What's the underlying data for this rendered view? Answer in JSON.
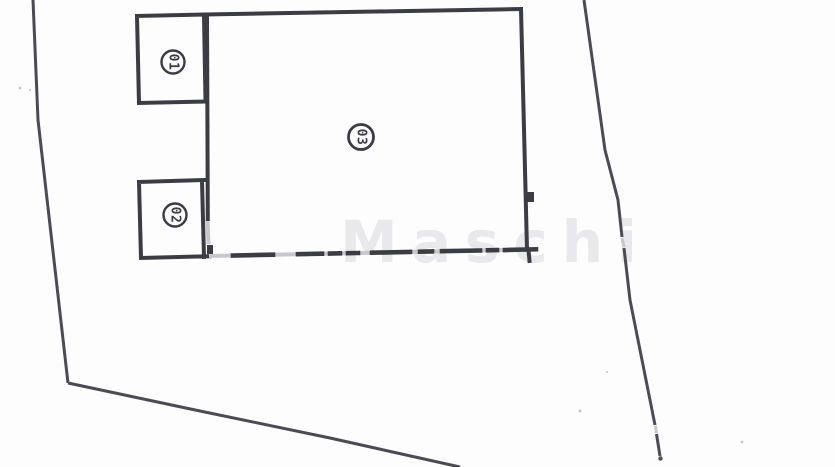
{
  "diagram": {
    "rooms": [
      {
        "label": "01"
      },
      {
        "label": "02"
      },
      {
        "label": "03"
      }
    ],
    "watermark_text": "Maschi"
  },
  "colors": {
    "background": "#fdfdfd",
    "building": "#3c3c43",
    "boundary": "#4b4b52",
    "ghost": "#c7c7cc",
    "watermark": "#e9e9ec",
    "speck": "#aaaab0"
  }
}
